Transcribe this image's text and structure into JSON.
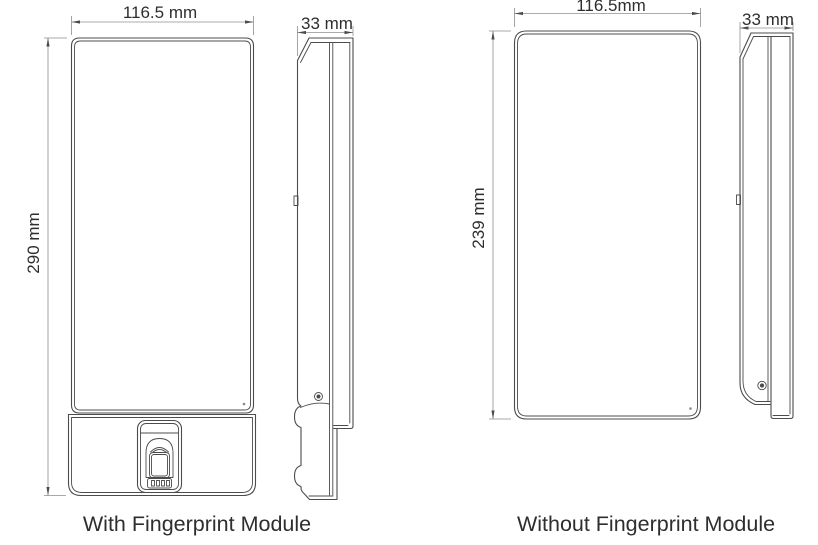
{
  "colors": {
    "background": "#ffffff",
    "outline": "#4c4c4c",
    "dimension_line": "#8f8f8f",
    "arrow": "#4c4c4c",
    "text": "#2e2e2e"
  },
  "with_module": {
    "caption": "With Fingerprint Module",
    "front_width": "116.5 mm",
    "front_height": "290 mm",
    "side_depth": "33 mm"
  },
  "without_module": {
    "caption": "Without Fingerprint Module",
    "front_width": "116.5mm",
    "front_height": "239 mm",
    "side_depth": "33 mm"
  }
}
